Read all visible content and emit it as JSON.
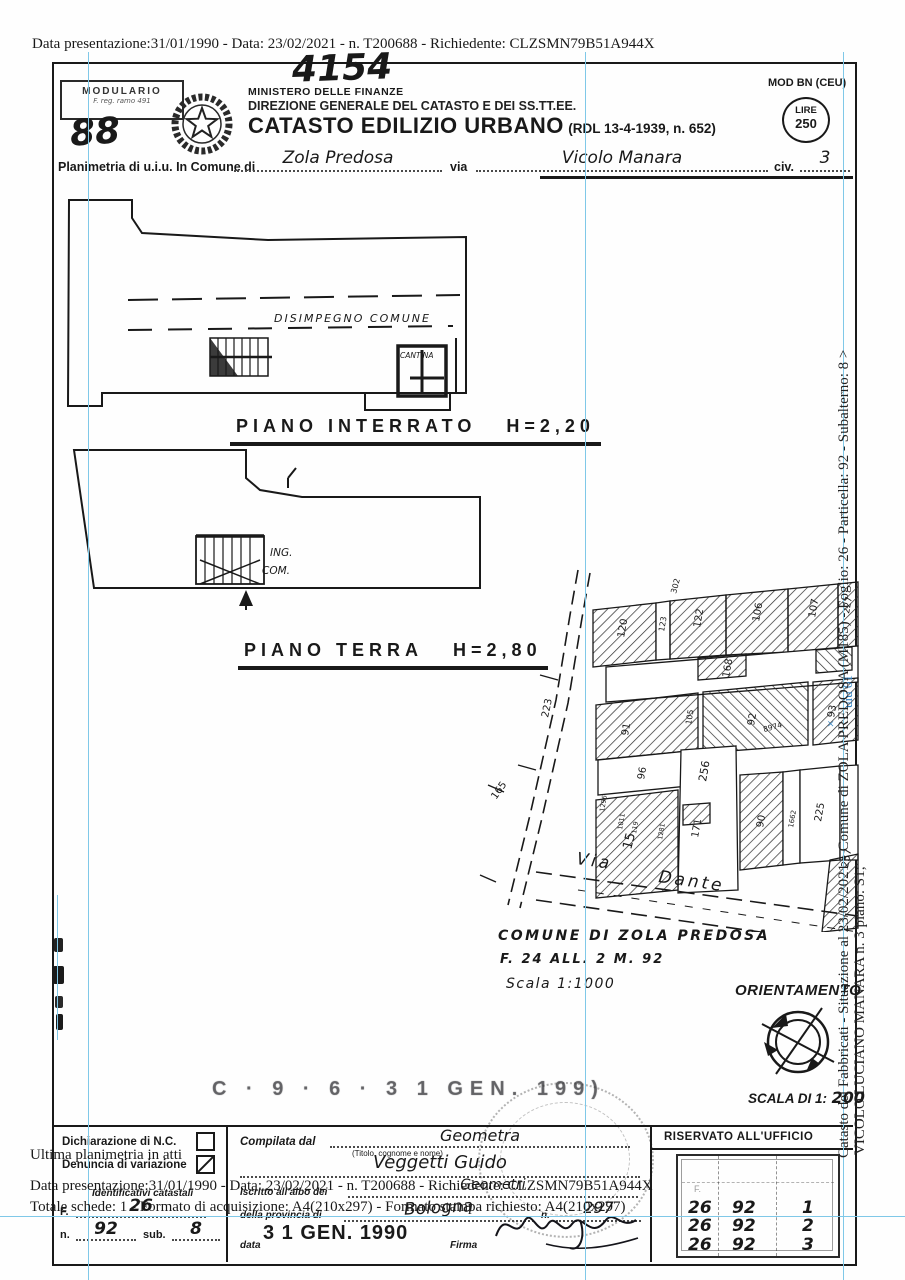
{
  "overlay": {
    "top_line": "Data presentazione:31/01/1990 - Data: 23/02/2021 - n. T200688 - Richiedente: CLZSMN79B51A944X",
    "ultima": "Ultima planimetria in atti",
    "data_line": "Data presentazione:31/01/1990 - Data: 23/02/2021 - n. T200688 - Richiedente: CLZSMN79B51A944X",
    "totale_line": "Totale schede: 1 - Formato di acquisizione: A4(210x297) - Formato stampa richiesto: A4(210x297)",
    "right_line1": "Catasto dei Fabbricati - Situazione al 23/02/2021 - Comune di ZOLA PREDOSA (M185) -  Foglio: 26 - Particella: 92 - Subalterno: 8 >",
    "right_line2": "VICOLO LUCIANO MANARA n. 3 piano: S1;",
    "uiu_note": "uiu 01",
    "blue_x": "×"
  },
  "header": {
    "modulario": "MODULARIO",
    "modulario_sub": "F. reg. ramo 491",
    "sheet_number_hand": "88",
    "protocol_hand": "4154",
    "ministero": "MINISTERO DELLE FINANZE",
    "direzione": "DIREZIONE GENERALE DEL CATASTO E DEI SS.TT.EE.",
    "title": "CATASTO EDILIZIO URBANO",
    "title_ref": "(RDL 13-4-1939, n. 652)",
    "mod": "MOD BN (CEU)",
    "lire_label": "LIRE",
    "lire_value": "250",
    "row_label1": "Planimetria di u.i.u. In Comune di",
    "comune_value": "Zola Predosa",
    "row_label2": "via",
    "via_value": "Vicolo Manara",
    "row_label3": "civ.",
    "civ_value": "3"
  },
  "plans": {
    "interrato": {
      "caption": "PIANO INTERRATO",
      "height": "H=2,20",
      "corridor": "DISIMPEGNO COMUNE",
      "cantina": "CANTINA"
    },
    "terra": {
      "caption": "PIANO TERRA",
      "height": "H=2,80",
      "ing": "ING.",
      "com": "COM."
    }
  },
  "map": {
    "parcels": [
      "120",
      "123",
      "302",
      "122",
      "106",
      "107",
      "227",
      "168",
      "91",
      "105",
      "92",
      "93",
      "96",
      "8974",
      "15",
      "256",
      "90",
      "1662",
      "225",
      "171",
      "257",
      "1296",
      "1011",
      "119",
      "1281"
    ],
    "road_measures": [
      "223",
      "165"
    ],
    "street_word1": "Via",
    "street_word2": "Dante",
    "note1": "COMUNE DI ZOLA PREDOSA",
    "note2": "F. 24  ALL. 2  M. 92",
    "note3": "Scala 1:1000",
    "orientamento": "ORIENTAMENTO",
    "scala_label": "SCALA DI 1:",
    "scala_value": "200"
  },
  "stamps": {
    "faded_line": "C · 9 · 6 · 3 1 GEN. 199)",
    "date_stamp": "3 1 GEN. 1990"
  },
  "footer": {
    "dichiarazione": "Dichiarazione di N.C.",
    "denuncia": "Denuncia di variazione",
    "identificativi": "Identificativi catastali",
    "f_label": "F.",
    "f_value": "26",
    "n_label": "n.",
    "n_value": "92",
    "sub_label": "sub.",
    "sub_value": "8",
    "compilata_label": "Compilata dal",
    "compilata_value": "Geometra",
    "titolo_note": "(Titolo, cognome e nome)",
    "nome_value": "Veggetti Guido",
    "iscritto_label": "Iscritto all'albo dei",
    "iscritto_value": "Geometri",
    "provincia_label": "della provincia di",
    "provincia_value": "Bologna",
    "albo_n_label": "n.",
    "albo_n_value": "297",
    "data_label": "data",
    "firma_label": "Firma",
    "riservato": "RISERVATO ALL'UFFICIO",
    "table": {
      "f_faint": "F.",
      "rows": [
        [
          "26",
          "92",
          "1"
        ],
        [
          "26",
          "92",
          "2"
        ],
        [
          "26",
          "92",
          "3"
        ]
      ]
    }
  }
}
